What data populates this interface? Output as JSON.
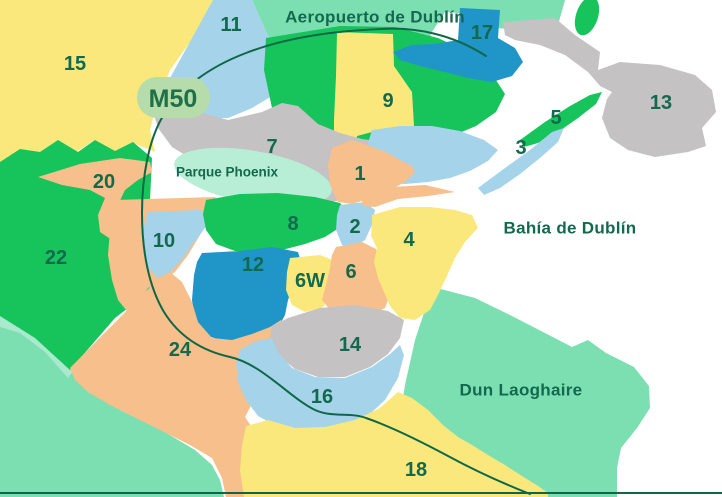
{
  "palette": {
    "sea": "#ffffff",
    "yellow": "#fbe87d",
    "orange": "#f6bf8b",
    "green": "#17c35b",
    "light_blue": "#a5d3ea",
    "blue": "#2095c8",
    "gray": "#c4c2c3",
    "mint": "#7cdfb2",
    "pale_mint": "#a9e9cd",
    "park_green": "#b9eed6",
    "badge_bg": "#b6dcab",
    "badge_text": "#1e7047",
    "label_text": "#12694e",
    "road_line": "#0e6847"
  },
  "districts": {
    "d1": {
      "label": "1",
      "color": "#f6bf8b"
    },
    "d2": {
      "label": "2",
      "color": "#a5d3ea"
    },
    "d3": {
      "label": "3",
      "color": "#a5d3ea"
    },
    "d4": {
      "label": "4",
      "color": "#fbe87d"
    },
    "d5": {
      "label": "5",
      "color": "#17c35b"
    },
    "d6": {
      "label": "6",
      "color": "#f6bf8b"
    },
    "d6w": {
      "label": "6W",
      "color": "#fbe87d"
    },
    "d7": {
      "label": "7",
      "color": "#c4c2c3"
    },
    "d8": {
      "label": "8",
      "color": "#17c35b"
    },
    "d9": {
      "label": "9",
      "color": "#fbe87d"
    },
    "d10": {
      "label": "10",
      "color": "#a5d3ea"
    },
    "d11": {
      "label": "11",
      "color": "#a5d3ea"
    },
    "d12": {
      "label": "12",
      "color": "#2095c8"
    },
    "d13": {
      "label": "13",
      "color": "#c4c2c3"
    },
    "d14": {
      "label": "14",
      "color": "#c4c2c3"
    },
    "d15": {
      "label": "15",
      "color": "#fbe87d"
    },
    "d16": {
      "label": "16",
      "color": "#a5d3ea"
    },
    "d17": {
      "label": "17",
      "color": "#2095c8"
    },
    "d18": {
      "label": "18",
      "color": "#fbe87d"
    },
    "d20": {
      "label": "20",
      "color": "#f6bf8b"
    },
    "d22": {
      "label": "22",
      "color": "#17c35b"
    },
    "d24": {
      "label": "24",
      "color": "#f6bf8b"
    }
  },
  "places": {
    "airport": "Aeropuerto de Dublín",
    "bay": "Bahía de Dublín",
    "dun_laoghaire": "Dun Laoghaire",
    "phoenix_park": "Parque Phoenix",
    "m50_badge": "M50"
  }
}
